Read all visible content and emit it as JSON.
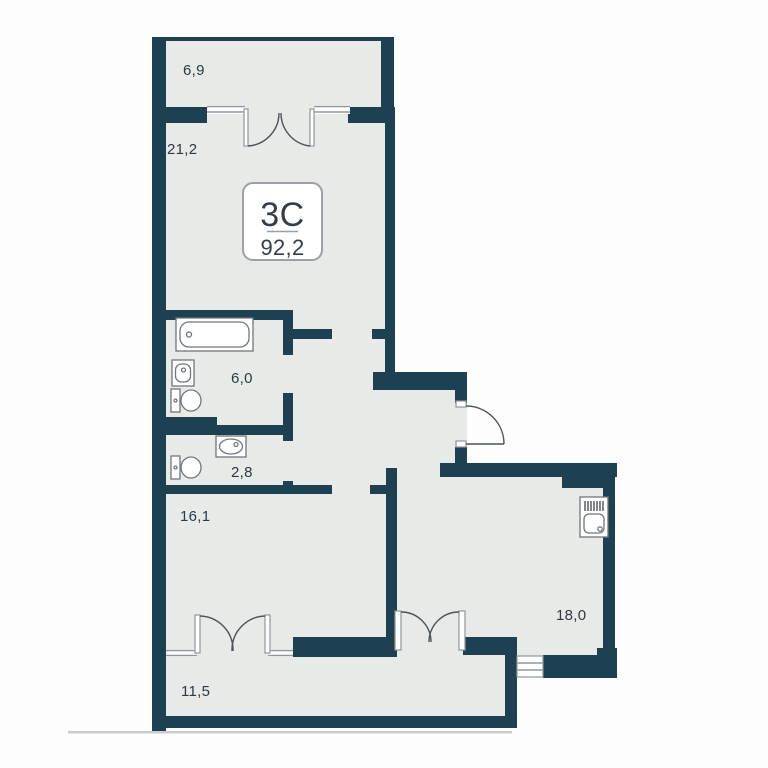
{
  "plan": {
    "badge": {
      "type": "3С",
      "area": "92,2"
    },
    "rooms": [
      {
        "id": "balcony-top",
        "area": "6,9"
      },
      {
        "id": "living-room",
        "area": "21,2"
      },
      {
        "id": "bathroom",
        "area": "6,0"
      },
      {
        "id": "wc",
        "area": "2,8"
      },
      {
        "id": "bedroom",
        "area": "16,1"
      },
      {
        "id": "balcony-bottom",
        "area": "11,5"
      },
      {
        "id": "kitchen-living",
        "area": "18,0"
      }
    ],
    "fixtures": [
      "bathtub",
      "sink",
      "toilet",
      "sink",
      "toilet",
      "kitchen-sink"
    ],
    "colors": {
      "wall": "#1d4052",
      "floor": "#e8eae7",
      "outside": "#fcfdfc",
      "line": "#8f979b",
      "fixture": "#6f767c",
      "text": "#2c3a45"
    }
  }
}
